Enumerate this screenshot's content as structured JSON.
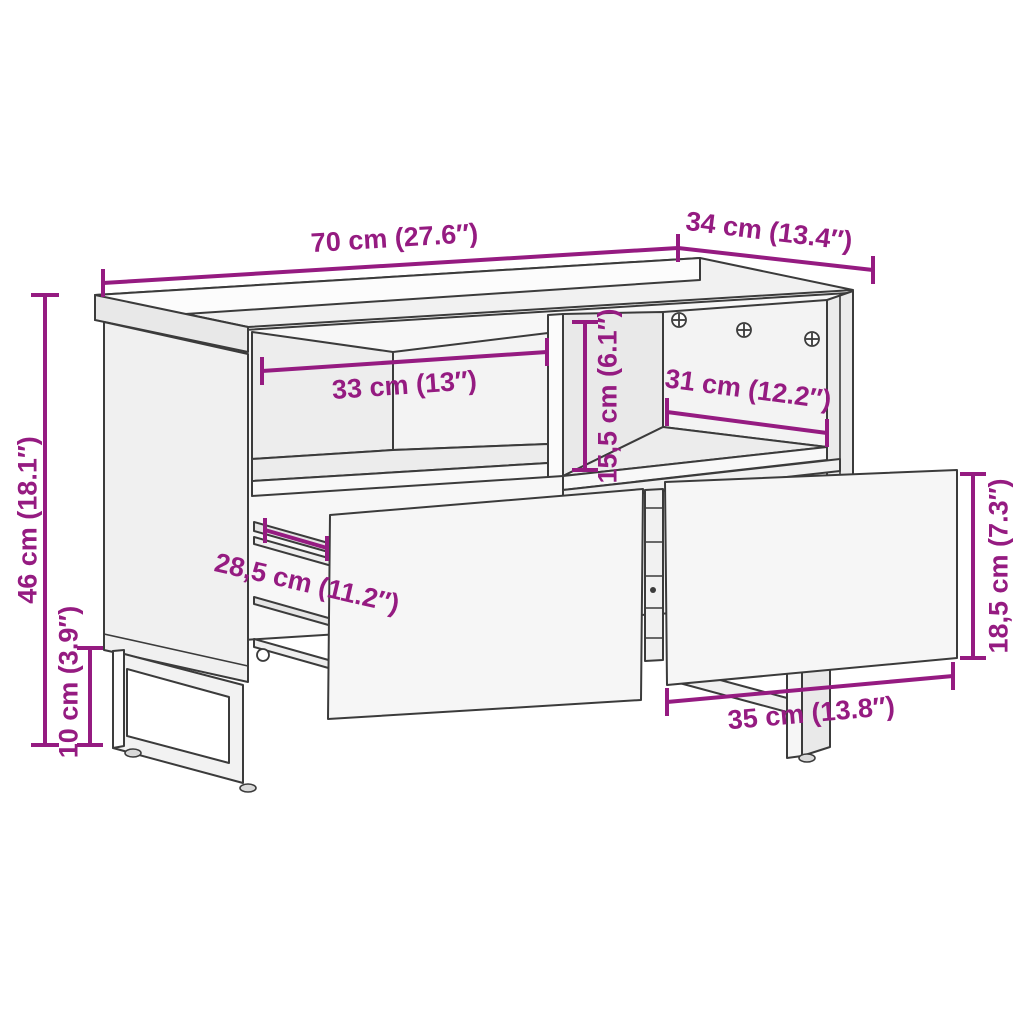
{
  "diagram": {
    "type": "furniture-dimension-diagram",
    "subject": "tv-cabinet-with-2-drawers-and-u-legs",
    "style": {
      "accent_color": "#951b81",
      "line_color": "#3b3b3b",
      "background": "#ffffff"
    },
    "dimensions": {
      "top_width": {
        "label": "70 cm (27.6″)"
      },
      "top_depth": {
        "label": "34 cm (13.4″)"
      },
      "total_height": {
        "label": "46 cm (18.1″)"
      },
      "leg_height": {
        "label": "10 cm (3.9″)"
      },
      "left_compartment_width": {
        "label": "33 cm (13″)"
      },
      "compartment_height": {
        "label": "15,5 cm (6.1″)"
      },
      "right_compartment_width": {
        "label": "31 cm (12.2″)"
      },
      "drawer_depth": {
        "label": "28,5 cm (11.2″)"
      },
      "drawer_front_height": {
        "label": "18,5 cm (7.3″)"
      },
      "drawer_front_width": {
        "label": "35 cm (13.8″)"
      }
    }
  }
}
